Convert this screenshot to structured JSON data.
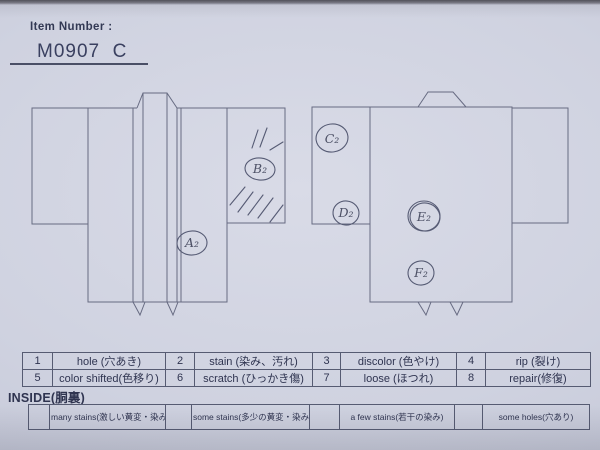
{
  "header": {
    "label": "Item Number :",
    "value": "M0907  C"
  },
  "diagram": {
    "front": {
      "marks": {
        "a": "A₂",
        "b": "B₂"
      }
    },
    "back": {
      "marks": {
        "c": "C₂",
        "d": "D₂",
        "e": "E₂",
        "f": "F₂"
      }
    }
  },
  "legend": {
    "rows": [
      [
        "1",
        "hole (穴あき)",
        "2",
        "stain (染み、汚れ)",
        "3",
        "discolor (色やけ)",
        "4",
        "rip (裂け)"
      ],
      [
        "5",
        "color shifted(色移り)",
        "6",
        "scratch (ひっかき傷)",
        "7",
        "loose (ほつれ)",
        "8",
        "repair(修復)"
      ]
    ]
  },
  "inside": {
    "title": "INSIDE(胴裏)",
    "cells": [
      "",
      "many stains(激しい黄変・染み)",
      "",
      "some stains(多少の黄変・染み)",
      "",
      "a few stains(若干の染み)",
      "",
      "some holes(穴あり)"
    ]
  },
  "colors": {
    "paper": "#cfd2e0",
    "ink": "#2f3450",
    "drawing_line": "#676b82",
    "handwriting": "#4d5166"
  }
}
